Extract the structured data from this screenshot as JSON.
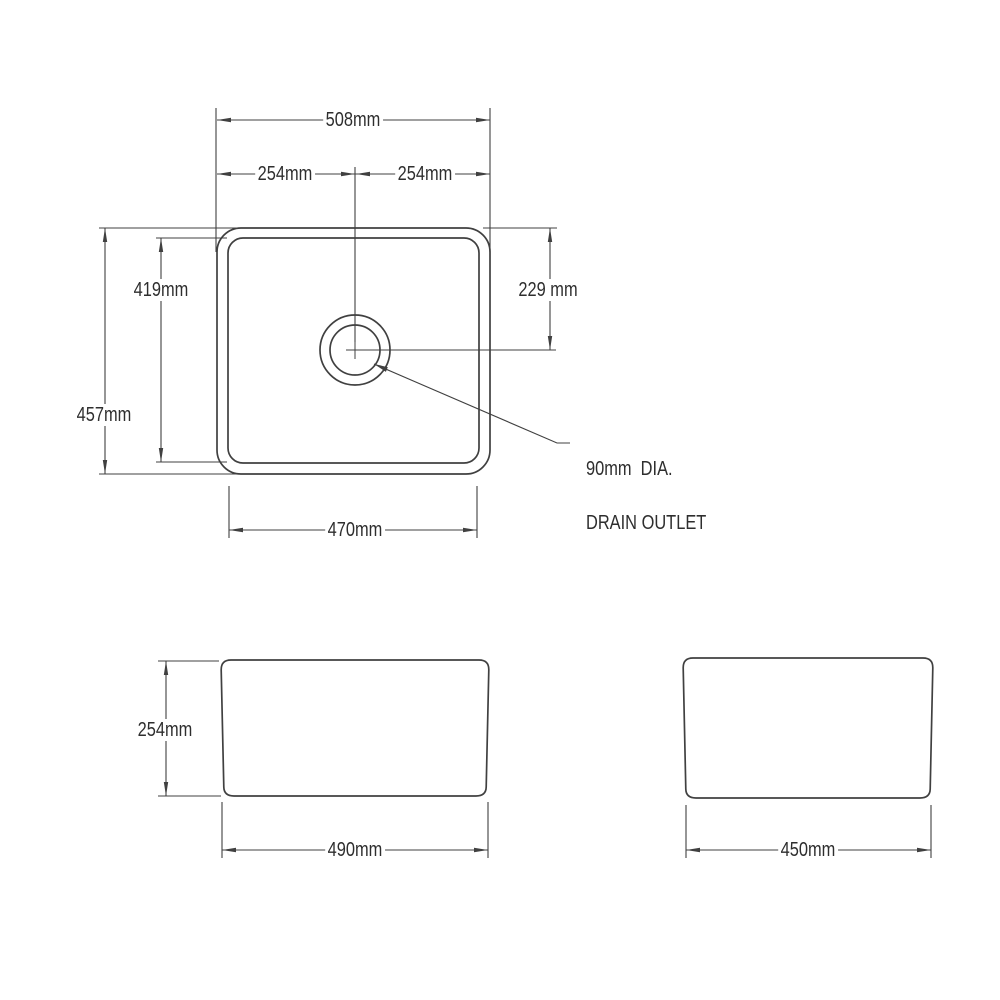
{
  "document": {
    "kind": "technical dimension drawing",
    "subject": "butler sink - plan, front and side views",
    "background_color": "#ffffff",
    "line_color": "#404040",
    "text_color": "#2e2e2e"
  },
  "top_view": {
    "overall_width": "508mm",
    "center_to_left": "254mm",
    "center_to_right": "254mm",
    "bowl_depth": "419mm",
    "overall_depth": "457mm",
    "drain_center_from_top": "229 mm",
    "bowl_width": "470mm",
    "drain_note_line1": "90mm  DIA.",
    "drain_note_line2": "DRAIN OUTLET"
  },
  "front_view": {
    "height": "254mm",
    "width": "490mm"
  },
  "side_view": {
    "width": "450mm"
  }
}
